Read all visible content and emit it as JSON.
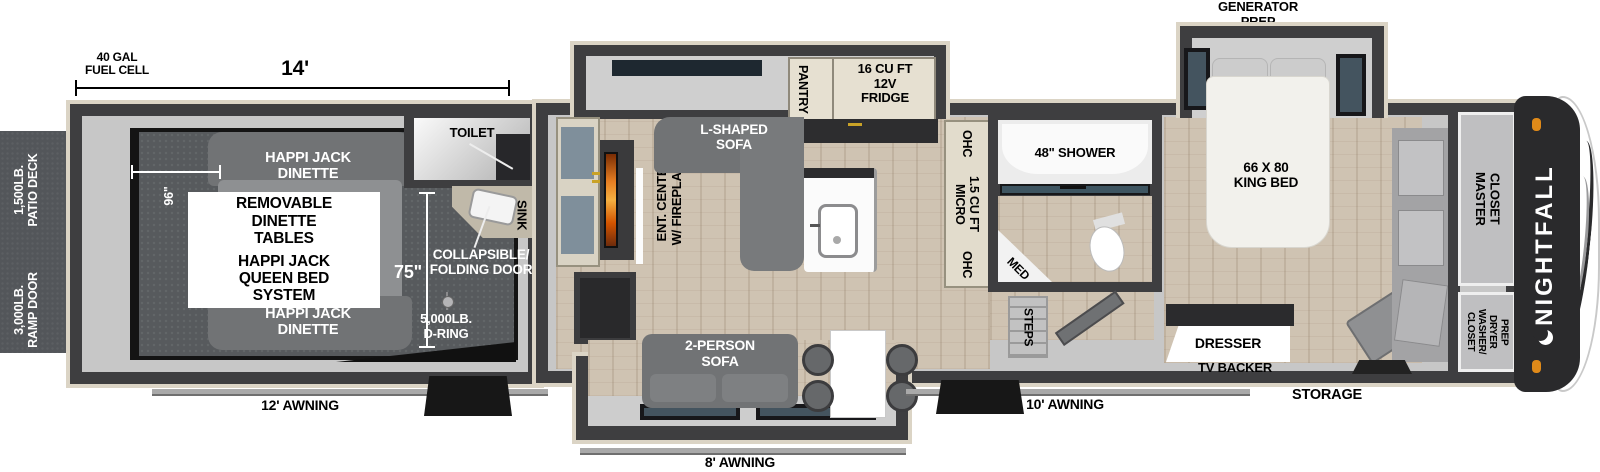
{
  "dims": {
    "garage_length": "14'",
    "fuel_cell": "40 GAL\nFUEL CELL",
    "garage_width": "96\"",
    "garage_depth": "75\""
  },
  "exterior": {
    "patio_deck": "1,500LB.\nPATIO DECK",
    "ramp_door": "3,000LB.\nRAMP DOOR",
    "generator_prep": "GENERATOR\nPREP",
    "awning_rear": "12' AWNING",
    "awning_center": "8' AWNING",
    "awning_front": "10' AWNING",
    "storage": "STORAGE",
    "brand": "NIGHTFALL"
  },
  "garage": {
    "dinette_front": "HAPPI JACK\nDINETTE",
    "dinette_rear": "HAPPI JACK\nDINETTE",
    "removable_tables": "REMOVABLE\nDINETTE\nTABLES",
    "queen_bed": "HAPPI JACK\nQUEEN BED\nSYSTEM",
    "toilet": "TOILET",
    "sink": "SINK",
    "folding_door": "COLLAPSIBLE/\nFOLDING DOOR",
    "d_ring": "5,000LB.\nD-RING"
  },
  "kitchen": {
    "pantry": "PANTRY",
    "fridge": "16 CU FT\n12V\nFRIDGE",
    "ohc_left": "OHC",
    "micro": "1.5 CU FT\nMICRO",
    "ohc_right": "OHC"
  },
  "living": {
    "l_sofa": "L-SHAPED\nSOFA",
    "ent_center": "ENT. CENTER\nW/ FIREPLACE",
    "sofa_2p": "2-PERSON\nSOFA"
  },
  "bath": {
    "shower": "48\" SHOWER",
    "med": "MED",
    "steps": "STEPS"
  },
  "bedroom": {
    "king_bed": "66 X 80\nKING BED",
    "dresser": "DRESSER",
    "tv_backer": "TV BACKER",
    "master_closet": "MASTER\nCLOSET",
    "washer_dryer": "CLOSET\nWASHER/\nDRYER\nPREP"
  },
  "colors": {
    "wall": "#3e3e40",
    "trim": "#dbd4c5",
    "interior": "#c7c7c7",
    "garage_floor": "#575a5d",
    "wood_floor": "#cfc3b2",
    "sofa_gray": "#717375",
    "front_cap": "#2a2a2c",
    "accent_orange": "#e08a19",
    "window_slate": "#44545f",
    "deck_gray": "#53565a"
  }
}
